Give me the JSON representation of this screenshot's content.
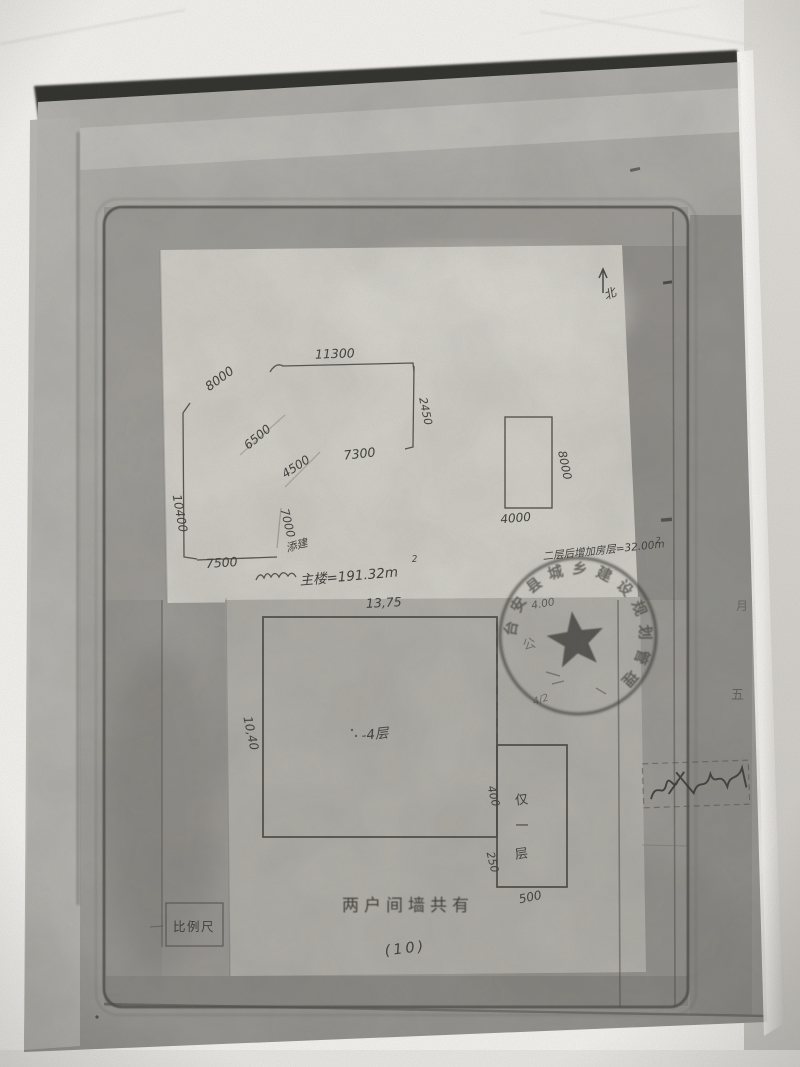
{
  "colors": {
    "photo_background": "#f4f2ef",
    "page_gray": "#a9a7a2",
    "sheet_white": "#d6d3cc",
    "ink": "#3c3a36",
    "stamp_ink": "#2f2d2a"
  },
  "north": {
    "label": "北"
  },
  "upper_sketch": {
    "dims": {
      "top": "11300",
      "upper_left": "8000",
      "right": "2450",
      "diag_a": "6500",
      "diag_b": "4500",
      "mid": "7300",
      "vertical": "7000",
      "left": "10400",
      "bottom": "7500"
    },
    "annex_rect": {
      "right": "8000",
      "bottom": "4000"
    },
    "note_small": "添建",
    "note_main": "主楼=191.32m",
    "note_main_sup": "2",
    "note_right": "二层后增加房层=32.00m",
    "note_right_sup": "2"
  },
  "lower_plan": {
    "dims": {
      "width": "13,75",
      "height": "10,40",
      "annex_top": "400",
      "annex_mid": "250",
      "annex_bottom": "500"
    },
    "floors_label": "-4层",
    "annex_label_chars": [
      "仅",
      "一",
      "层"
    ],
    "faint_note_top": "4.00",
    "faint_note_mid": "4/2",
    "caption": "两户间墙共有",
    "page_number": "(10)",
    "scale_label": "比例尺"
  },
  "stamp": {
    "ring_text": "台安县城乡建设规划管理",
    "inner_char": "公"
  },
  "margin_marks": {
    "right_upper": "月",
    "right_lower": "五"
  }
}
